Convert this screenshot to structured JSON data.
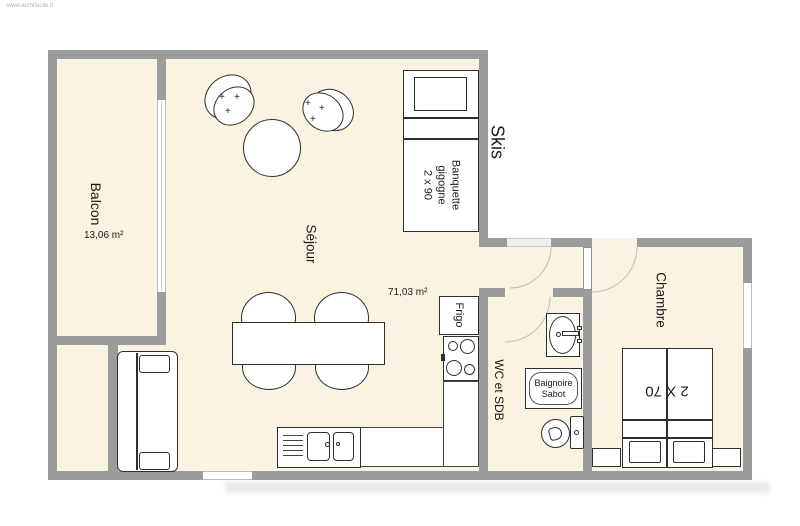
{
  "watermark": "www.archifacile.fr",
  "colors": {
    "room_fill": "#FAF3E1",
    "wall": "#9C9C9C",
    "furniture_outline": "#2F2F2F",
    "door_arc": "#BDBDBD",
    "background": "#FFFFFF"
  },
  "rooms": {
    "balcon": {
      "name": "Balcon",
      "area": "13,06 m²"
    },
    "sejour": {
      "name": "Séjour",
      "area": "71,03 m²"
    },
    "skis": {
      "name": "Skis"
    },
    "wc_sdb": {
      "name": "WC et SDB"
    },
    "chambre": {
      "name": "Chambre"
    }
  },
  "furniture": {
    "banquette": {
      "line1": "Banquette",
      "line2": "gigogne",
      "line3": "2 x 90"
    },
    "frigo": {
      "name": "Frigo"
    },
    "baignoire": {
      "line1": "Baignoire",
      "line2": "Sabot"
    },
    "bed": {
      "size": "2 X 70"
    },
    "armchair_mark": "+"
  }
}
